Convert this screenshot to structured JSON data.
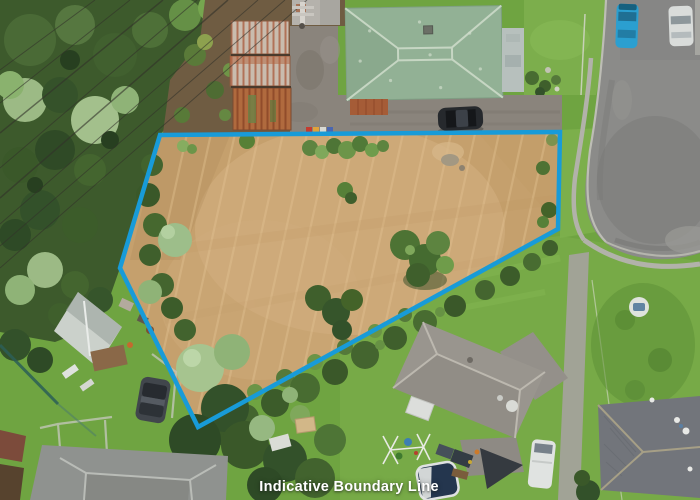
{
  "caption": {
    "text": "Indicative Boundary Line",
    "color": "#ffffff"
  },
  "boundary": {
    "color": "#189bd8",
    "stroke_width": "4.5",
    "points": "160,135 560,132 558,229 198,427 120,268"
  },
  "scene": {
    "type": "aerial-drone-photo",
    "features": [
      "vacant-cleared-lot",
      "indicative-boundary-overlay",
      "green-roof-house-north",
      "rusted-corrugated-sheds",
      "cul-de-sac-road-east",
      "parked-blue-car",
      "parked-white-car",
      "black-car-on-driveway",
      "grey-roof-house-south",
      "grey-roof-house-southeast",
      "white-garden-shed-west",
      "trampoline",
      "swing-set",
      "power-lines-northwest",
      "dense-trees-west"
    ]
  }
}
